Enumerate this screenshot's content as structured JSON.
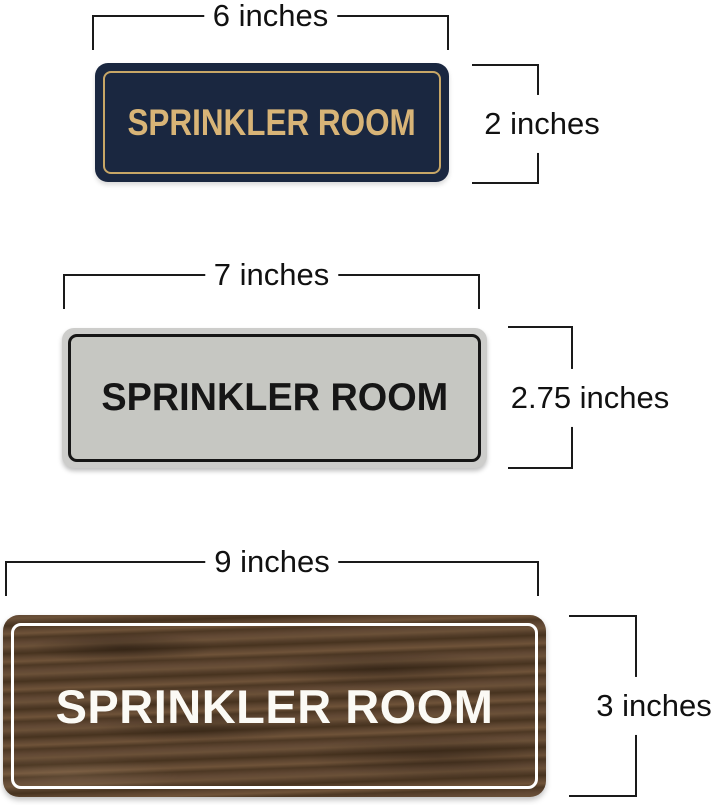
{
  "diagram": {
    "background": "#ffffff",
    "line_color": "#1a1a1a",
    "label_color": "#111111"
  },
  "signs": [
    {
      "style": "navy-gold",
      "text": "SPRINKLER ROOM",
      "width_label": "6 inches",
      "height_label": "2 inches",
      "plate_color": "#1a2740",
      "border_color": "#c7a666",
      "text_color": "#d8b477"
    },
    {
      "style": "silver-black",
      "text": "SPRINKLER ROOM",
      "width_label": "7 inches",
      "height_label": "2.75 inches",
      "frame_color": "#cdcdcb",
      "plate_color": "#c6c7c2",
      "border_color": "#161616",
      "text_color": "#161616"
    },
    {
      "style": "walnut-white",
      "text": "SPRINKLER ROOM",
      "width_label": "9 inches",
      "height_label": "3 inches",
      "plate_color": "#55402c",
      "border_color": "#ffffff",
      "text_color": "#fbfaf5"
    }
  ]
}
